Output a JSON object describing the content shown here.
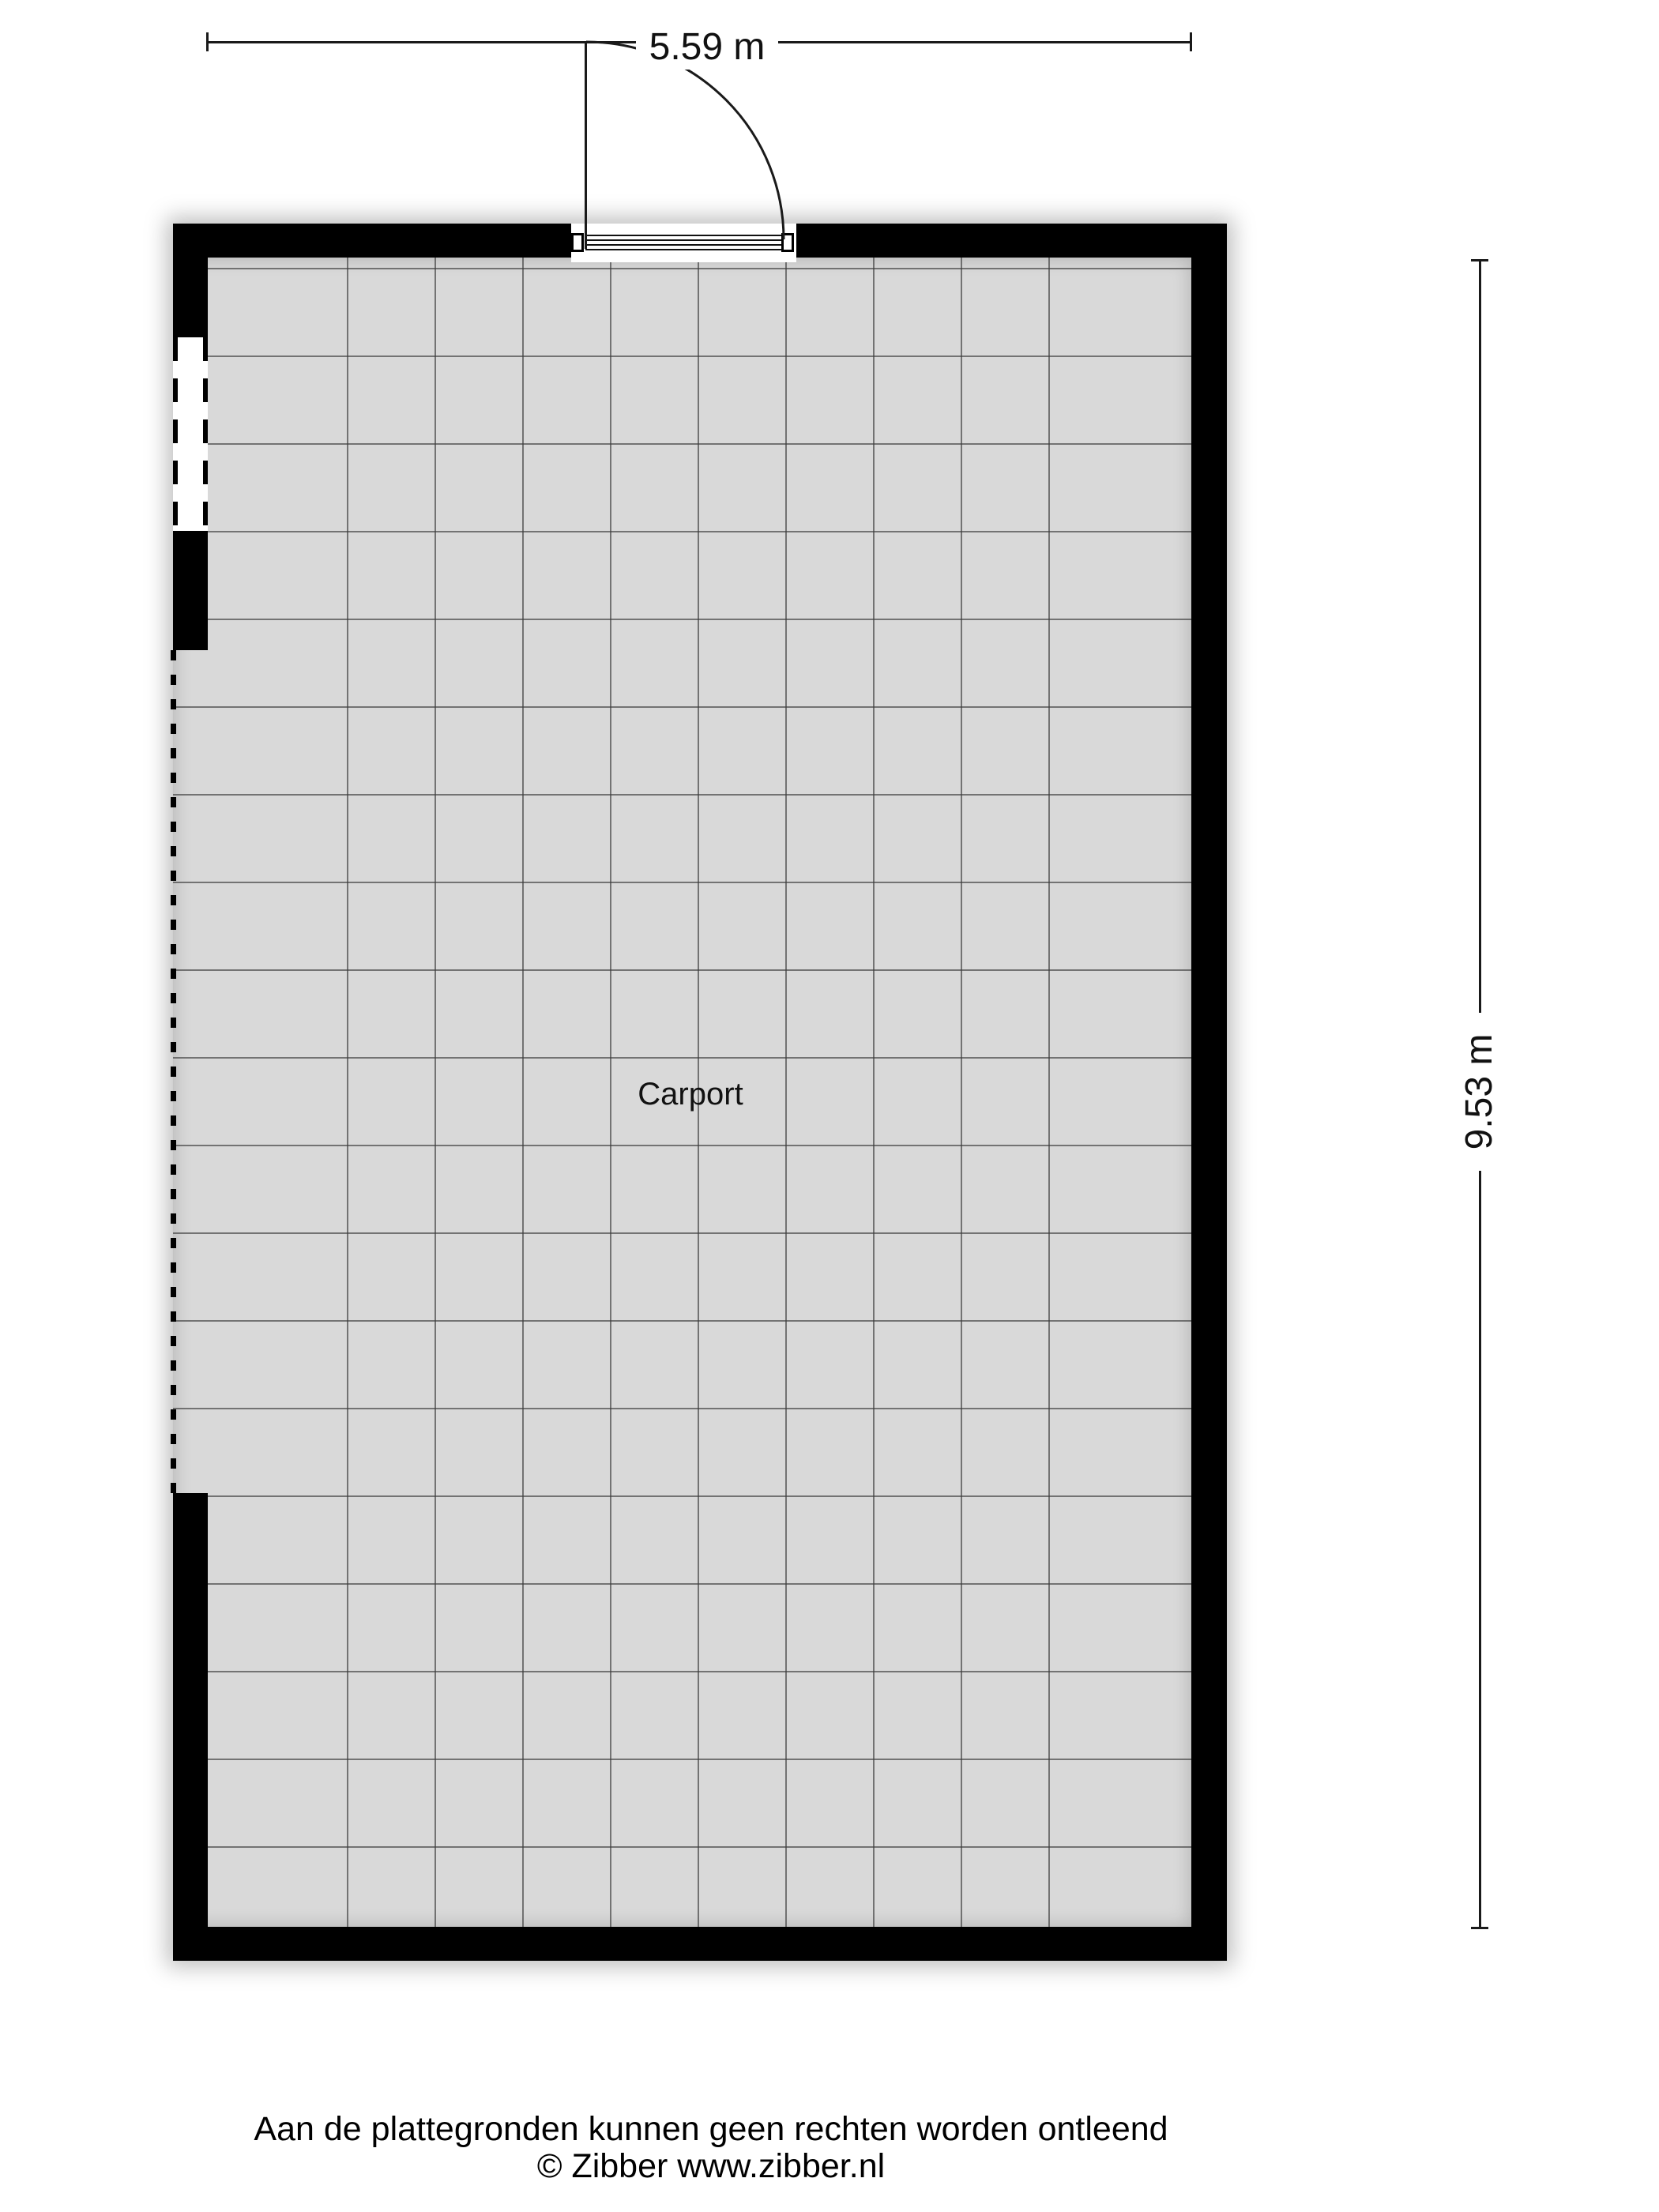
{
  "plan": {
    "room_label": "Carport",
    "width_dimension": "5.59 m",
    "height_dimension": "9.53 m"
  },
  "footer": {
    "disclaimer": "Aan de plattegronden kunnen geen rechten worden ontleend",
    "copyright": "© Zibber www.zibber.nl"
  },
  "colors": {
    "wall": "#000000",
    "floor": "#d9d9d9",
    "grid_line": "#3c3c3c",
    "background": "#ffffff",
    "text": "#111111"
  }
}
